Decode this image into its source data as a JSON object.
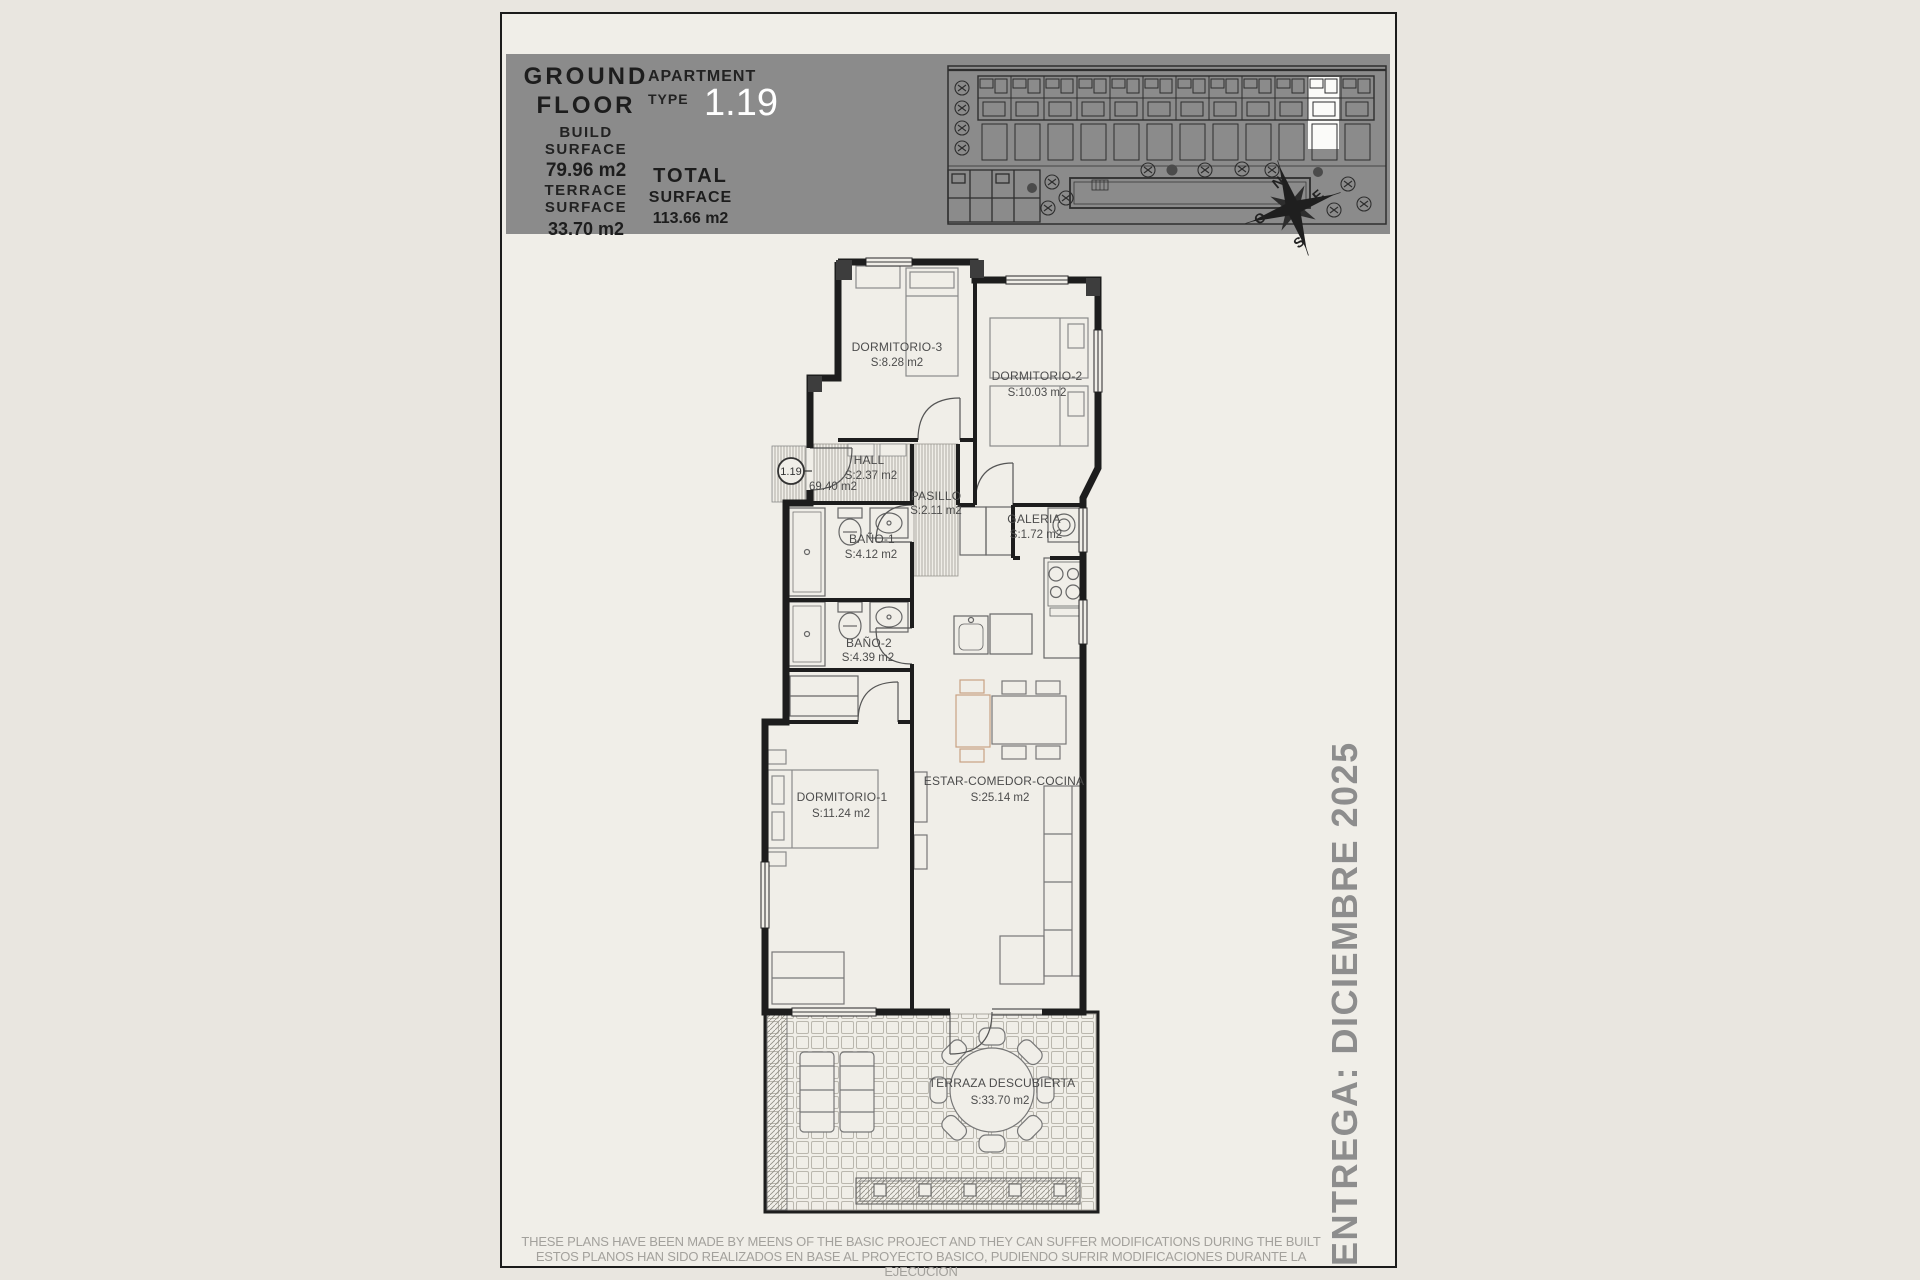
{
  "header": {
    "floor": [
      "GROUND",
      "FLOOR"
    ],
    "build_label": [
      "BUILD",
      "SURFACE"
    ],
    "build_value": "79.96 m2",
    "terrace_label": [
      "TERRACE",
      "SURFACE"
    ],
    "terrace_value": "33.70 m2",
    "apartment_label": [
      "APARTMENT",
      "TYPE"
    ],
    "apartment_number": "1.19",
    "total_label": [
      "TOTAL",
      "SURFACE"
    ],
    "total_value": "113.66 m2"
  },
  "compass": {
    "north": "N",
    "east": "E",
    "south": "S",
    "west": "O"
  },
  "plan": {
    "unit_badge": "1.19",
    "unit_area_note": "69.40 m2",
    "rooms": [
      {
        "name": "DORMITORIO-3",
        "area": "S:8.28 m2"
      },
      {
        "name": "DORMITORIO-2",
        "area": "S:10.03 m2"
      },
      {
        "name": "HALL",
        "area": "S:2.37 m2"
      },
      {
        "name": "PASILLO",
        "area": "S:2.11 m2"
      },
      {
        "name": "GALERIA",
        "area": "S:1.72 m2"
      },
      {
        "name": "BAÑO-1",
        "area": "S:4.12 m2"
      },
      {
        "name": "BAÑO-2",
        "area": "S:4.39 m2"
      },
      {
        "name": "DORMITORIO-1",
        "area": "S:11.24 m2"
      },
      {
        "name": "ESTAR-COMEDOR-COCINA",
        "area": "S:25.14 m2"
      },
      {
        "name": "TERRAZA DESCUBIERTA",
        "area": "S:33.70 m2"
      }
    ]
  },
  "side_note": "ENTREGA: DICIEMBRE 2025",
  "disclaimer": [
    "THESE PLANS HAVE BEEN MADE BY MEENS OF THE BASIC PROJECT AND THEY CAN SUFFER MODIFICATIONS DURING THE BUILT",
    "ESTOS PLANOS HAN SIDO REALIZADOS EN BASE AL PROYECTO BASICO, PUDIENDO SUFRIR MODIFICACIONES DURANTE LA EJECUCION"
  ],
  "colors": {
    "band_gray": "#8b8b8b",
    "page_bg": "#f0eee8",
    "outer_bg": "#e9e6e0",
    "highlight_white": "#ffffff",
    "wall_dark": "#1d1d1d",
    "label_gray": "#4c4c4c",
    "wood_tan": "#c9a183",
    "muted_text": "#8d8d8d"
  }
}
